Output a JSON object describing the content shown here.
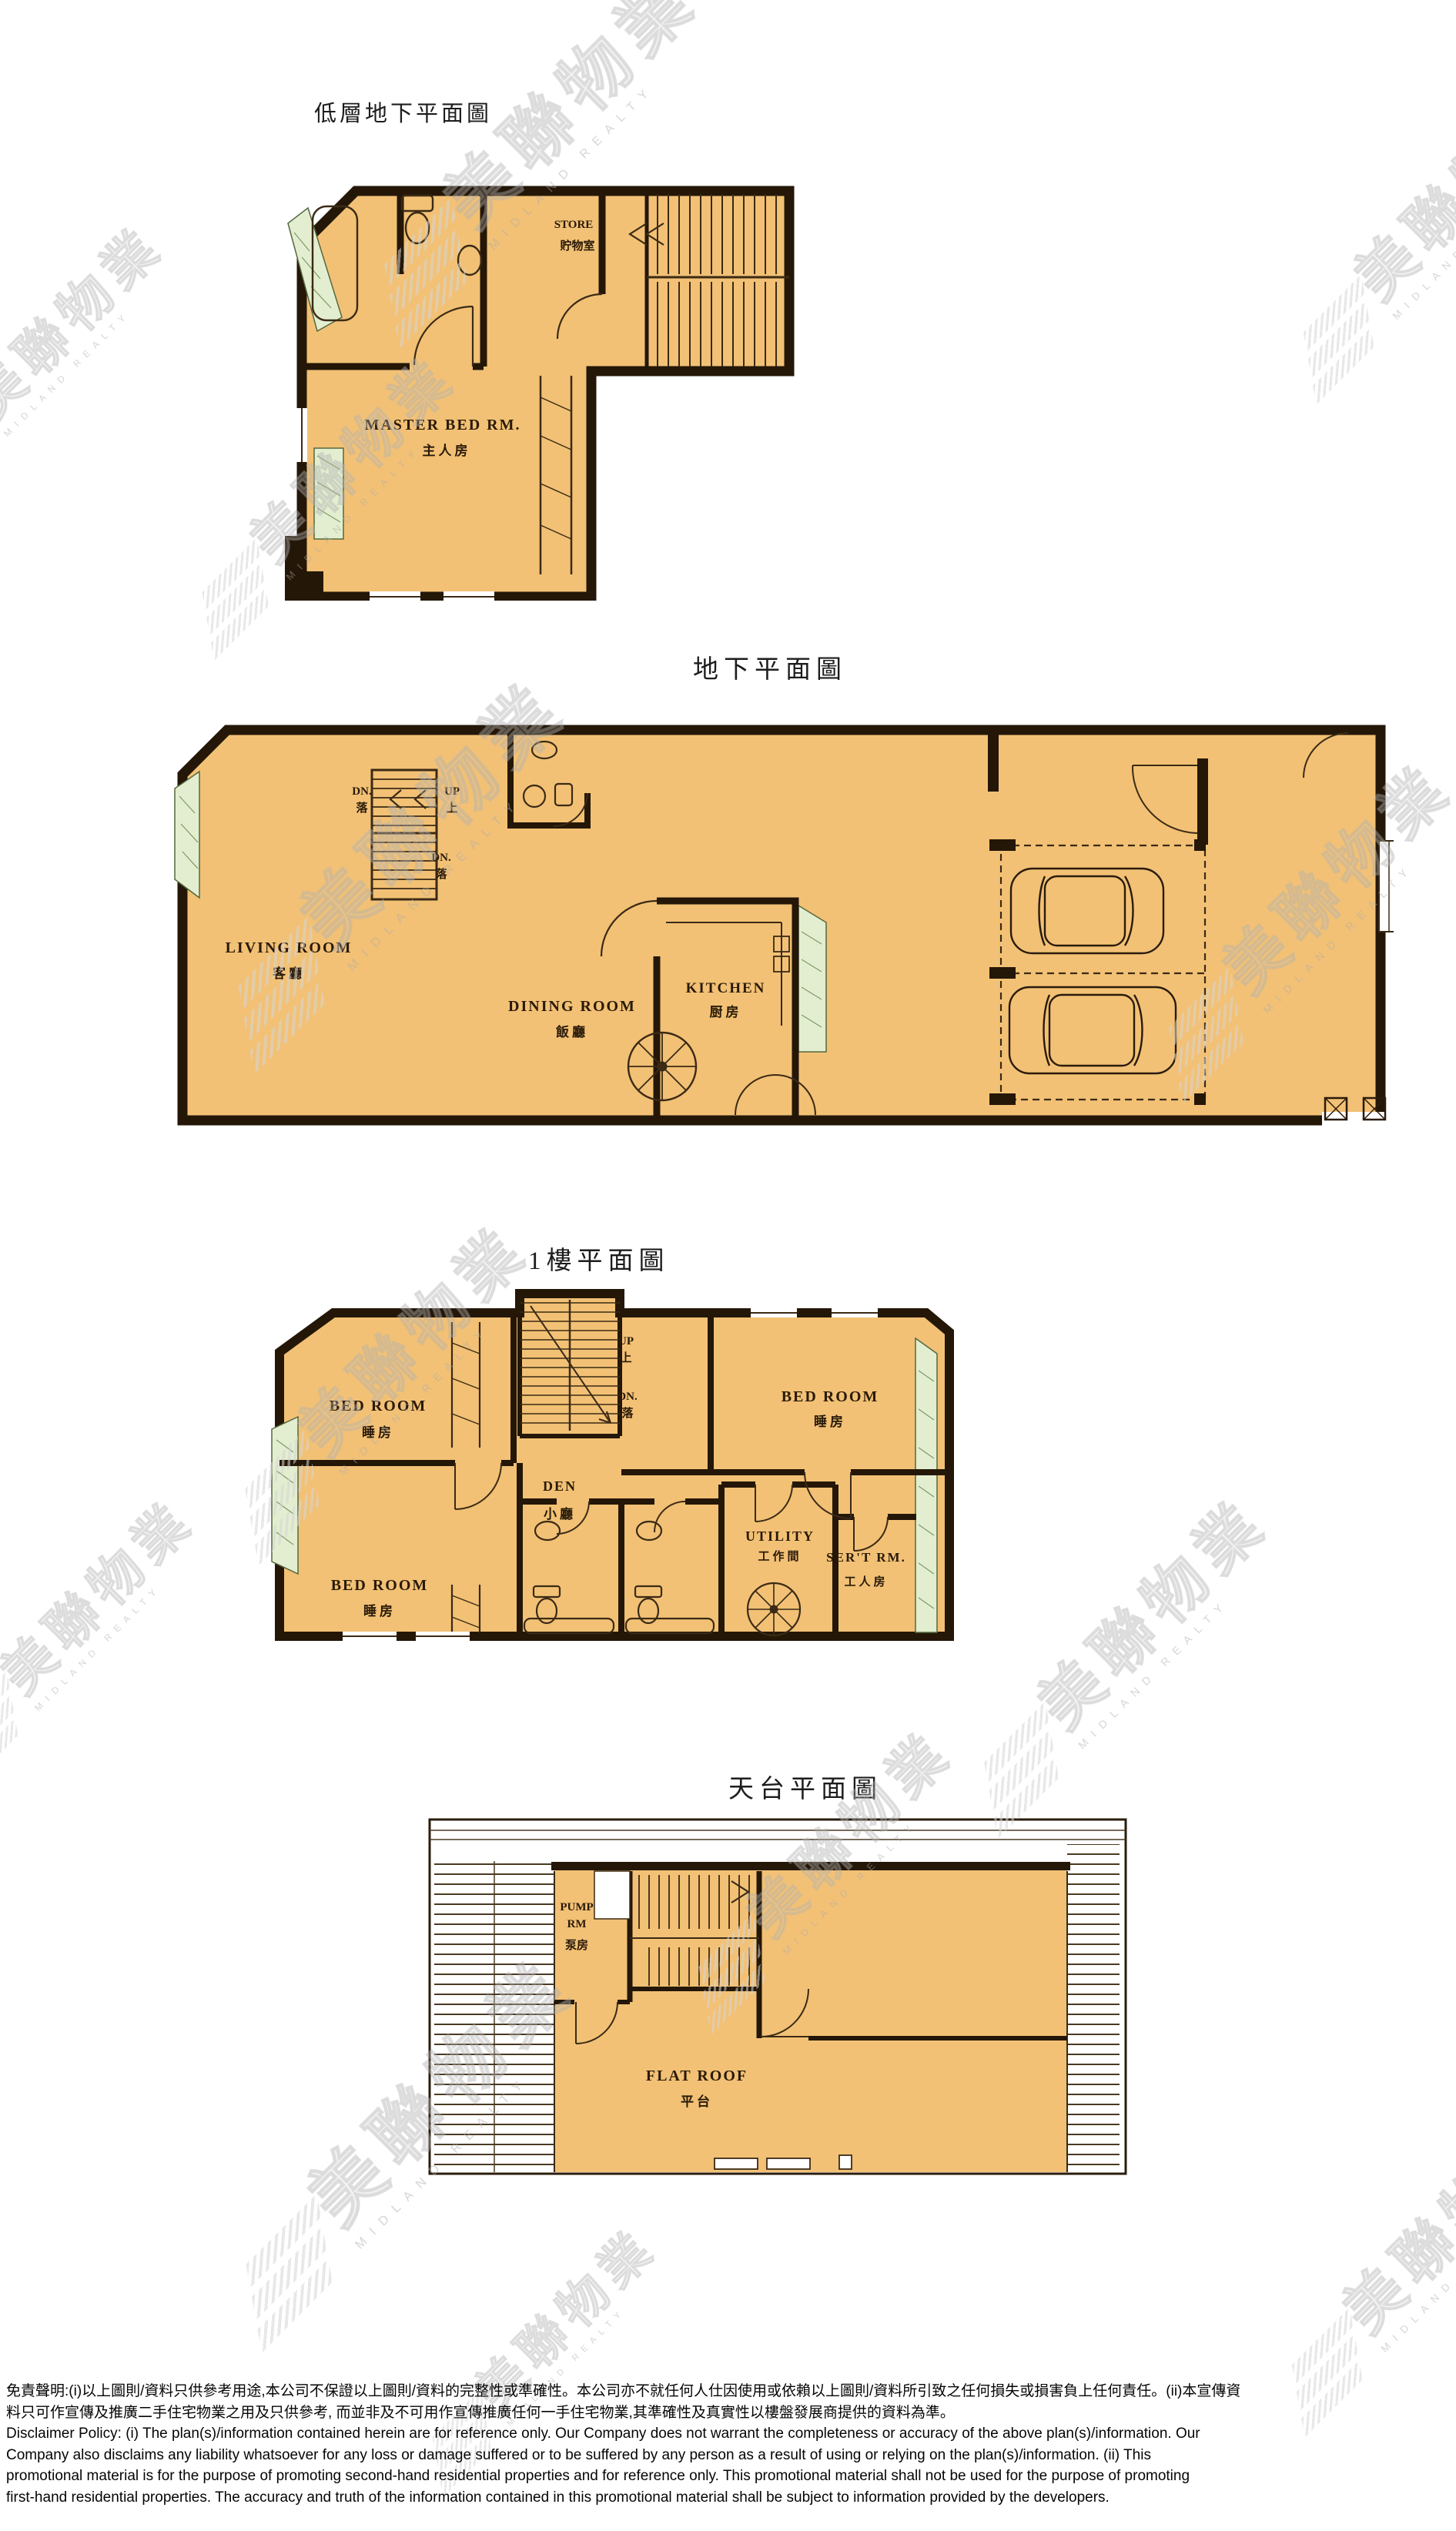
{
  "watermark": {
    "cjk": "美聯物業",
    "latin": "MIDLAND REALTY"
  },
  "plans": {
    "lower_ground": {
      "title": "低層地下平面圖",
      "store_en": "STORE",
      "store_zh": "貯物室",
      "master_en": "MASTER BED RM.",
      "master_zh": "主人房"
    },
    "ground": {
      "title": "地下平面圖",
      "living_en": "LIVING ROOM",
      "living_zh": "客廳",
      "dining_en": "DINING ROOM",
      "dining_zh": "飯廳",
      "kitchen_en": "KITCHEN",
      "kitchen_zh": "厨房",
      "dn": "DN.",
      "dn_zh": "落",
      "up": "UP",
      "up_zh": "上"
    },
    "first": {
      "title": "1樓平面圖",
      "bed_en": "BED ROOM",
      "bed_zh": "睡房",
      "den_en": "DEN",
      "den_zh": "小廳",
      "utility_en": "UTILITY",
      "utility_zh": "工作間",
      "servant_en": "SER'T RM.",
      "servant_zh": "工人房",
      "up": "UP",
      "up_zh": "上",
      "dn": "DN.",
      "dn_zh": "落"
    },
    "roof": {
      "title": "天台平面圖",
      "pump_en_1": "PUMP",
      "pump_en_2": "RM",
      "pump_zh": "泵房",
      "flat_roof_en": "FLAT ROOF",
      "flat_roof_zh": "平台"
    }
  },
  "disclaimer": {
    "zh1": "免責聲明:(i)以上圖則/資料只供參考用途,本公司不保證以上圖則/資料的完整性或準確性。本公司亦不就任何人仕因使用或依賴以上圖則/資料所引致之任何損失或損害負上任何責任。(ii)本宣傳資",
    "zh2": "料只可作宣傳及推廣二手住宅物業之用及只供參考, 而並非及不可用作宣傳推廣任何一手住宅物業,其準確性及真實性以樓盤發展商提供的資料為準。",
    "en1": "Disclaimer Policy: (i) The plan(s)/information contained herein are for reference only. Our Company does not warrant the completeness or accuracy of the above plan(s)/information. Our",
    "en2": "Company also disclaims any liability whatsoever for any loss or damage suffered or to be suffered by any person as a result of using or relying on the plan(s)/information. (ii) This",
    "en3": "promotional material is for the purpose of promoting second-hand residential properties and for reference only. This promotional material shall not be used for the purpose of promoting",
    "en4": "first-hand residential properties. The accuracy and truth of the information contained in this promotional material shall be subject to information provided by the developers."
  },
  "colors": {
    "floor": "#f2c175",
    "wall": "#241708",
    "planter": "#e3eed0",
    "watermark": "#d6d6d6"
  }
}
